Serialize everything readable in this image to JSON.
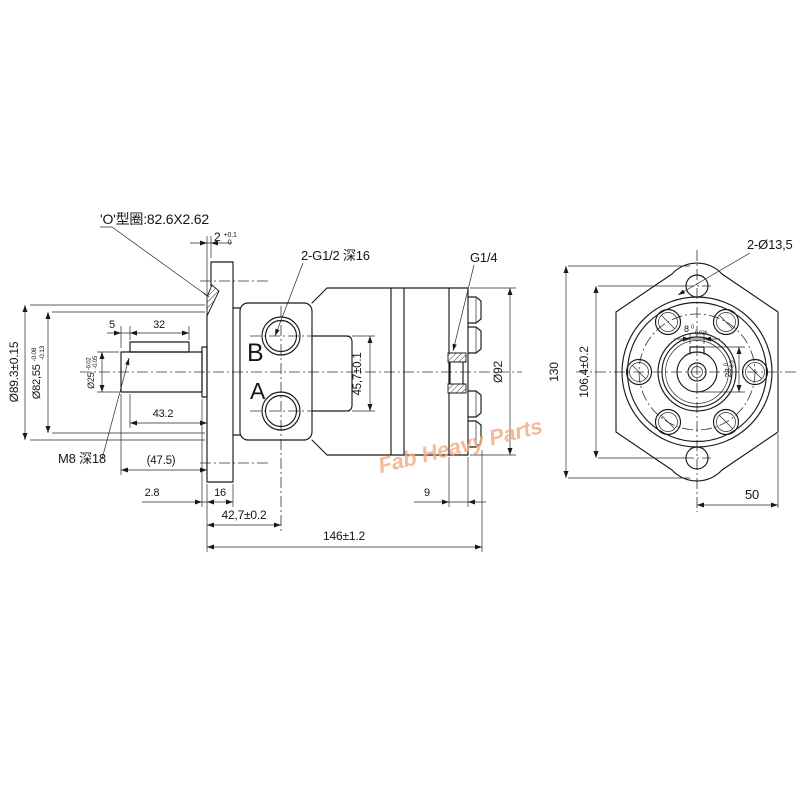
{
  "drawing": {
    "watermark": "Fab Heavy Parts",
    "side_view": {
      "oring_label": "'O'型圈:82.6X2.62",
      "ports_label": "2-G1/2 深16",
      "drain_label": "G1/4",
      "thread_label": "M8 深18",
      "port_b": "B",
      "port_a": "A",
      "dims": {
        "step": {
          "main": "2",
          "plus": "+0.1",
          "minus": "0"
        },
        "pilot_outer": "Ø89.3±0.15",
        "pilot": {
          "main": "Ø82,55",
          "plus": "-0.08",
          "minus": "-0.13"
        },
        "shaft": {
          "main": "Ø25",
          "plus": "-0.02",
          "minus": "-0.05"
        },
        "key_offset": "5",
        "key_length": "32",
        "shaft_length": "43.2",
        "shaft_total": "(47.5)",
        "shoulder": "2.8",
        "flange_thickness": "16",
        "port_center": "42,7±0.2",
        "overall_length": "146±1.2",
        "cover": "9",
        "body_dia": "Ø92",
        "port_spacing": "45,7±0.1"
      }
    },
    "end_view": {
      "holes_label": "2-Ø13,5",
      "dims": {
        "flange_height": "130",
        "hole_spacing": "106,4±0.2",
        "half_width": "50",
        "key_width": {
          "main": "8",
          "plus": "0",
          "minus": "-0.036"
        },
        "key_height": {
          "main": "28",
          "plus": "0",
          "minus": "-0.3"
        }
      }
    }
  }
}
